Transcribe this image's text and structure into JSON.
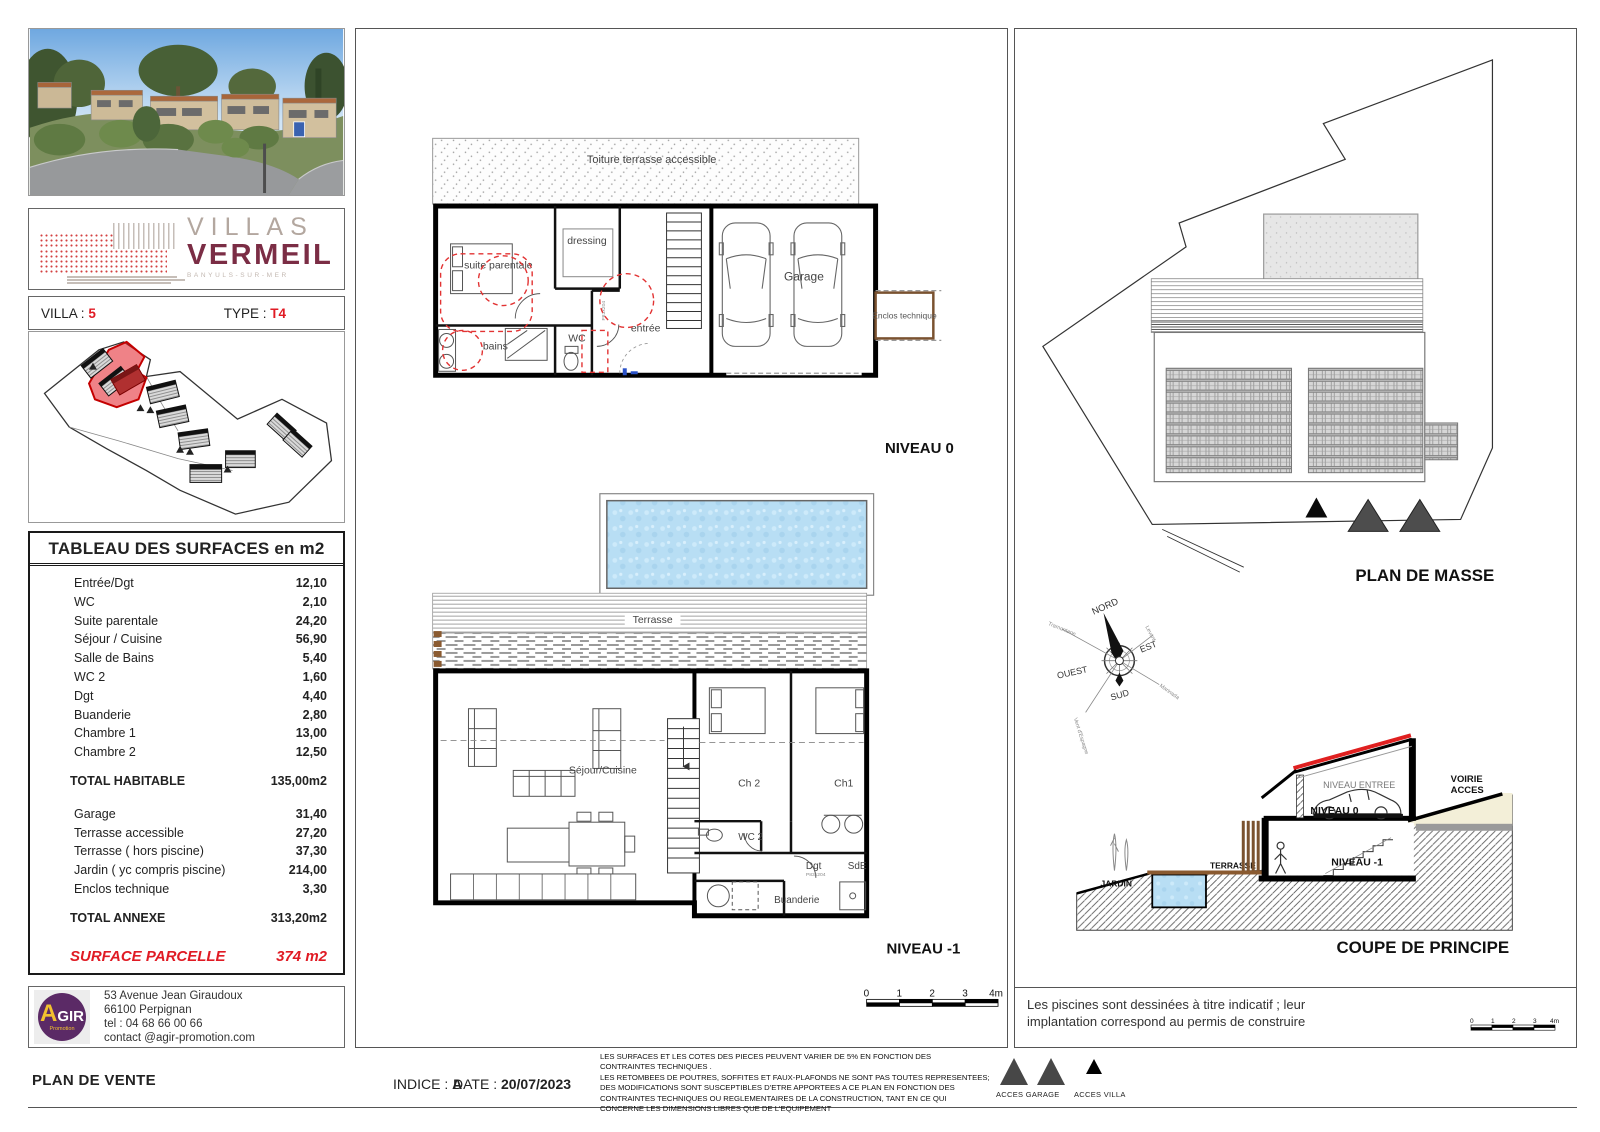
{
  "meta": {
    "sheet_title": "PLAN DE VENTE",
    "indice_label": "INDICE :",
    "indice_value": "A",
    "date_label": "DATE :",
    "date_value": "20/07/2023"
  },
  "branding": {
    "logo_line1": "VILLAS",
    "logo_line2": "VERMEIL",
    "logo_sub": "BANYULS-SUR-MER"
  },
  "villa": {
    "villa_label": "VILLA :",
    "villa_number": "5",
    "type_label": "TYPE :",
    "type_value": "T4"
  },
  "surfaces": {
    "title": "TABLEAU DES SURFACES en m2",
    "rows": [
      {
        "label": "Entrée/Dgt",
        "value": "12,10"
      },
      {
        "label": "WC",
        "value": "2,10"
      },
      {
        "label": "Suite parentale",
        "value": "24,20"
      },
      {
        "label": "Séjour / Cuisine",
        "value": "56,90"
      },
      {
        "label": "Salle de Bains",
        "value": "5,40"
      },
      {
        "label": "WC 2",
        "value": "1,60"
      },
      {
        "label": "Dgt",
        "value": "4,40"
      },
      {
        "label": "Buanderie",
        "value": "2,80"
      },
      {
        "label": "Chambre 1",
        "value": "13,00"
      },
      {
        "label": "Chambre 2",
        "value": "12,50"
      }
    ],
    "total_habitable": {
      "label": "TOTAL HABITABLE",
      "value": "135,00m2"
    },
    "annex_rows": [
      {
        "label": "Garage",
        "value": "31,40"
      },
      {
        "label": "Terrasse accessible",
        "value": "27,20"
      },
      {
        "label": "Terrasse ( hors piscine)",
        "value": "37,30"
      },
      {
        "label": "Jardin ( yc compris piscine)",
        "value": "214,00"
      },
      {
        "label": "Enclos technique",
        "value": "3,30"
      }
    ],
    "total_annexe": {
      "label": "TOTAL ANNEXE",
      "value": "313,20m2"
    },
    "parcel": {
      "label": "SURFACE PARCELLE",
      "value": "374 m2"
    }
  },
  "contact": {
    "logo_big": "A",
    "logo_rest": "GIR",
    "logo_sub": "Promotion",
    "address1": "53 Avenue Jean Giraudoux",
    "address2": "66100 Perpignan",
    "phone": "tel : 04 68 66 00 66",
    "email": "contact @agir-promotion.com"
  },
  "niveau0": {
    "title": "NIVEAU 0",
    "labels": {
      "toiture": "Toiture terrasse accessible",
      "suite": "suite parentale",
      "dressing": "dressing",
      "bains": "bains",
      "wc": "WC",
      "entree": "entrée",
      "garage": "Garage",
      "enclos": "Enclos technique"
    }
  },
  "niveau1": {
    "title": "NIVEAU -1",
    "labels": {
      "terrasse": "Terrasse",
      "sejour": "Séjour/Cuisine",
      "ch2": "Ch 2",
      "ch1": "Ch1",
      "wc2": "WC 2",
      "dgt": "Dgt",
      "sde": "SdE",
      "buanderie": "Buanderie"
    },
    "door_tag": "P83x204"
  },
  "masse": {
    "title": "PLAN DE MASSE",
    "compass": {
      "nord": "NORD",
      "est": "EST",
      "sud": "SUD",
      "ouest": "OUEST",
      "wind_nw": "Tramontane",
      "wind_ne": "Levant",
      "wind_se": "Marinada",
      "wind_sw": "Vent d'Espagne"
    }
  },
  "coupe": {
    "title": "COUPE DE PRINCIPE",
    "labels": {
      "jardin": "JARDIN",
      "terrasse": "TERRASSE",
      "niveau_entree": "NIVEAU ENTREE",
      "niveau0": "NIVEAU 0",
      "niveau_m1": "NIVEAU -1",
      "voirie1": "VOIRIE",
      "voirie2": "ACCES"
    }
  },
  "notes": {
    "pool_note_line1": "Les piscines sont dessinées à titre indicatif ; leur",
    "pool_note_line2": "implantation correspond au permis de construire",
    "fine_print": [
      "LES SURFACES ET LES COTES DES PIECES PEUVENT VARIER DE 5% EN FONCTION DES",
      "CONTRAINTES TECHNIQUES .",
      "LES RETOMBEES DE POUTRES, SOFFITES ET FAUX-PLAFONDS NE SONT PAS TOUTES REPRESENTEES;",
      "DES MODIFICATIONS SONT SUSCEPTIBLES D'ETRE APPORTEES A CE PLAN EN FONCTION DES",
      "CONTRAINTES TECHNIQUES OU REGLEMENTAIRES DE LA CONSTRUCTION, TANT EN CE QUI",
      "CONCERNE LES DIMENSIONS LIBRES QUE DE L'EQUIPEMENT"
    ],
    "acces_garage": "ACCES GARAGE",
    "acces_villa": "ACCES VILLA"
  },
  "scale": {
    "t0": "0",
    "t1": "1",
    "t2": "2",
    "t3": "3",
    "t4": "4m"
  },
  "colors": {
    "accent_red": "#e01b24",
    "maroon": "#7b2d45",
    "agir_purple": "#5b2a66",
    "agir_yellow": "#f2c12e",
    "pool_blue": "#b8def4",
    "wood_brown": "#8a5a30"
  }
}
